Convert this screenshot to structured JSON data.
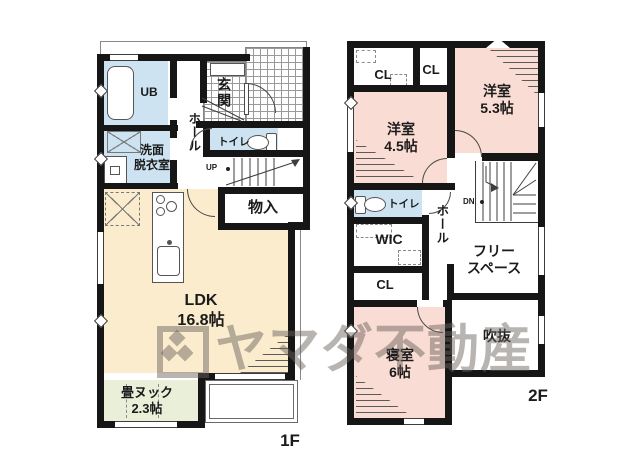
{
  "watermark": {
    "text": "ヤマダ不動産"
  },
  "floor1": {
    "floor_label": "1F",
    "ub": "UB",
    "washroom_1": "洗面",
    "washroom_2": "脱衣室",
    "genkan": "玄関",
    "hall": "ホール",
    "toilet": "トイレ",
    "stairs_up": "UP",
    "storage": "物入",
    "ldk_1": "LDK",
    "ldk_2": "16.8帖",
    "nook_1": "畳ヌック",
    "nook_2": "2.3帖"
  },
  "floor2": {
    "floor_label": "2F",
    "closet1": "CL",
    "closet2": "CL",
    "closet3": "CL",
    "room53_1": "洋室",
    "room53_2": "5.3帖",
    "room45_1": "洋室",
    "room45_2": "4.5帖",
    "toilet": "トイレ",
    "wic": "WIC",
    "hall": "ホール",
    "stairs_down": "DN",
    "free_1": "フリー",
    "free_2": "スペース",
    "void": "吹抜",
    "bedroom_1": "寝室",
    "bedroom_2": "6帖"
  },
  "colors": {
    "wall": "#161616",
    "pink": "#f9dcd3",
    "cream": "#faeccd",
    "blue": "#cde3f2",
    "green": "#e9efd9",
    "tile": "#9a9a9a",
    "wm": "rgba(104,99,93,0.48)"
  }
}
